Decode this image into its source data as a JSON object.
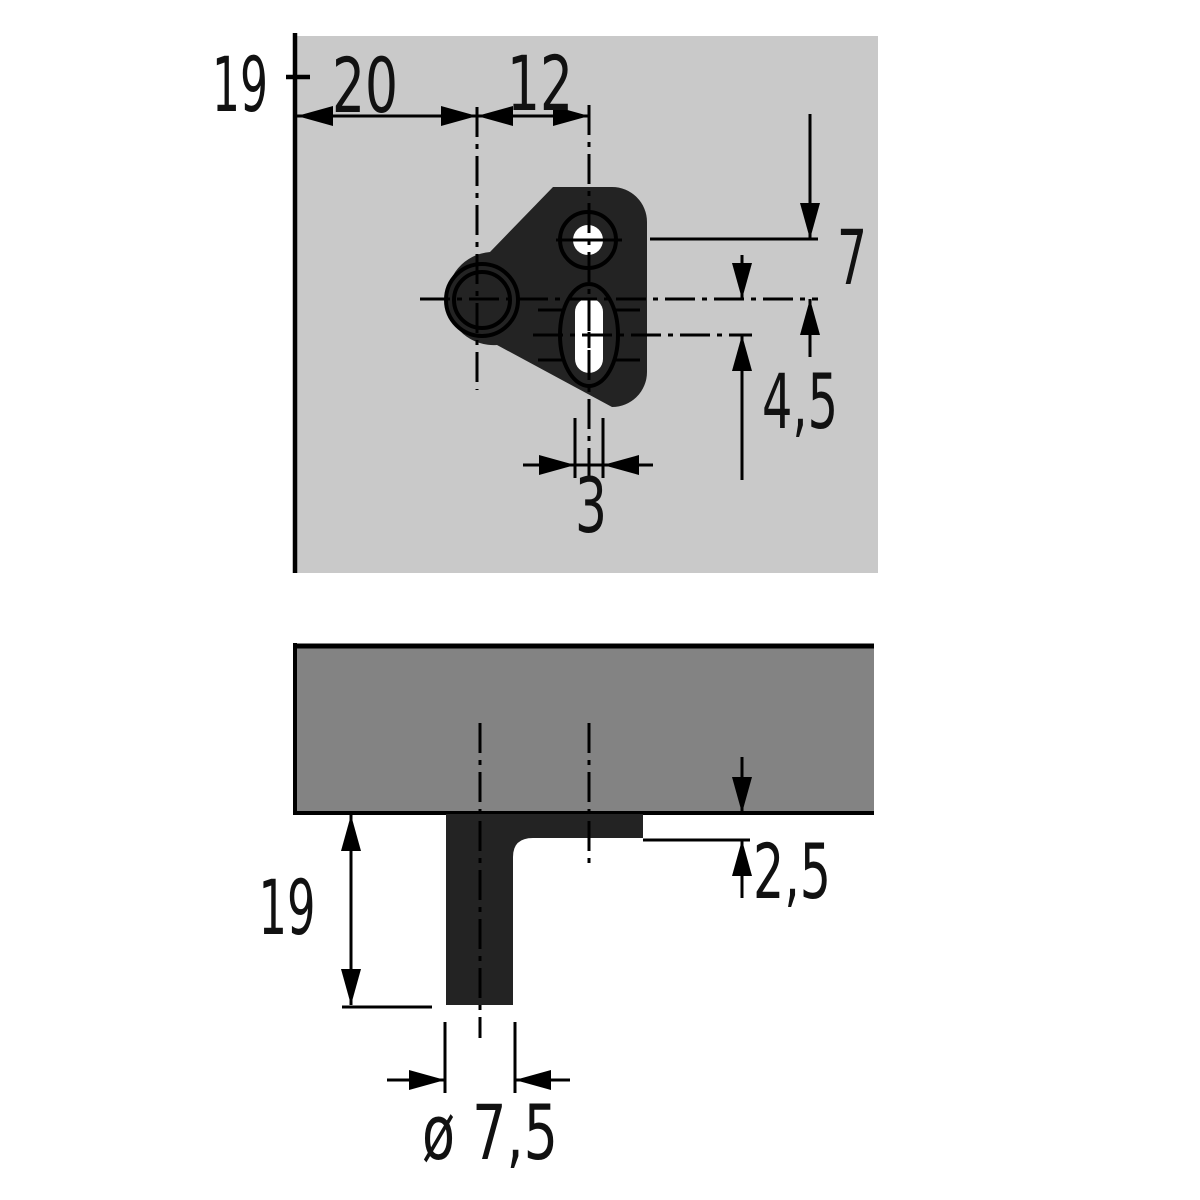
{
  "drawing": {
    "title": "Furniture fitting mounting drawing, two views with millimetre dimensions",
    "colors": {
      "board_top_view": "#c9c9c9",
      "board_side_view": "#838383",
      "fitting": "#232323",
      "lines": "#000000",
      "background": "#ffffff"
    },
    "top_view": {
      "labels": {
        "board_thickness": "19",
        "edge_distance": "20",
        "hole_spacing": "12",
        "hole_offset": "7",
        "slot_length": "4,5",
        "slot_width": "3"
      }
    },
    "side_view": {
      "labels": {
        "depth_below_board": "19",
        "flange_thickness": "2,5",
        "pin_diameter": "ø 7,5"
      }
    }
  }
}
